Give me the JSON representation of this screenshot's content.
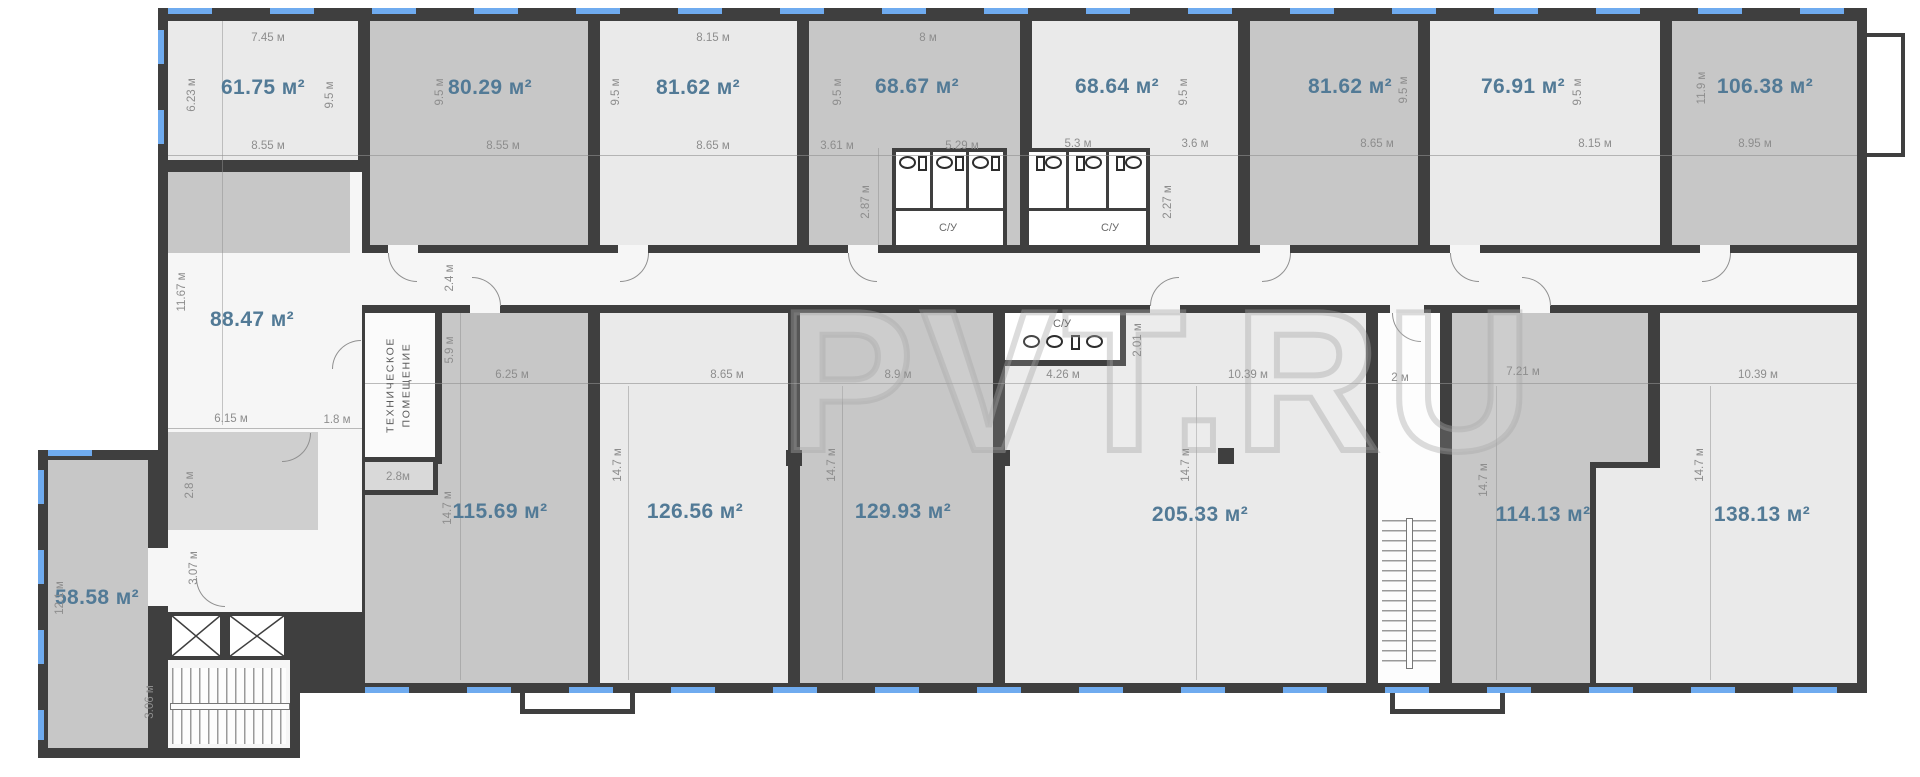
{
  "watermark": "PVT.RU",
  "wc_label": "С/У",
  "tech_room": {
    "line1": "ТЕХНИЧЕСКОЕ",
    "line2": "ПОМЕЩЕНИЕ"
  },
  "areas": [
    "61.75 м²",
    "80.29 м²",
    "81.62 м²",
    "68.67 м²",
    "68.64 м²",
    "81.62 м²",
    "76.91 м²",
    "106.38 м²",
    "88.47 м²",
    "115.69 м²",
    "126.56 м²",
    "129.93 м²",
    "205.33 м²",
    "114.13 м²",
    "138.13 м²",
    "58.58 м²"
  ],
  "dims": [
    "7.45 м",
    "6.23 м",
    "9.5 м",
    "8.55 м",
    "9.5 м",
    "8.55 м",
    "8.15 м",
    "9.5 м",
    "8.65 м",
    "8 м",
    "9.5 м",
    "3.61 м",
    "5.29 м",
    "5.3 м",
    "3.6 м",
    "9.5 м",
    "8.65 м",
    "9.5 м",
    "8.15 м",
    "9.5 м",
    "11.9 м",
    "8.95 м",
    "2.87 м",
    "2.27 м",
    "2.4 м",
    "2.01 м",
    "4.26 м",
    "8.9 м",
    "6.25 м",
    "5.9 м",
    "14.7 м",
    "8.65 м",
    "14.7 м",
    "14.7 м",
    "10.39 м",
    "14.7 м",
    "2 м",
    "7.21 м",
    "14.7 м",
    "10.39 м",
    "14.7 м",
    "11.67 м",
    "6.15 м",
    "1.8 м",
    "2.8 м",
    "3.07 м",
    "2.8м",
    "12.1 м",
    "3.06 м"
  ],
  "colors": {
    "wall": "#3f3f3f",
    "room_light": "#eaeaea",
    "room_dark": "#c7c7c7",
    "area_text": "#527a96",
    "dim_text": "#8d8d8d",
    "window_blue": "#6fabef"
  }
}
